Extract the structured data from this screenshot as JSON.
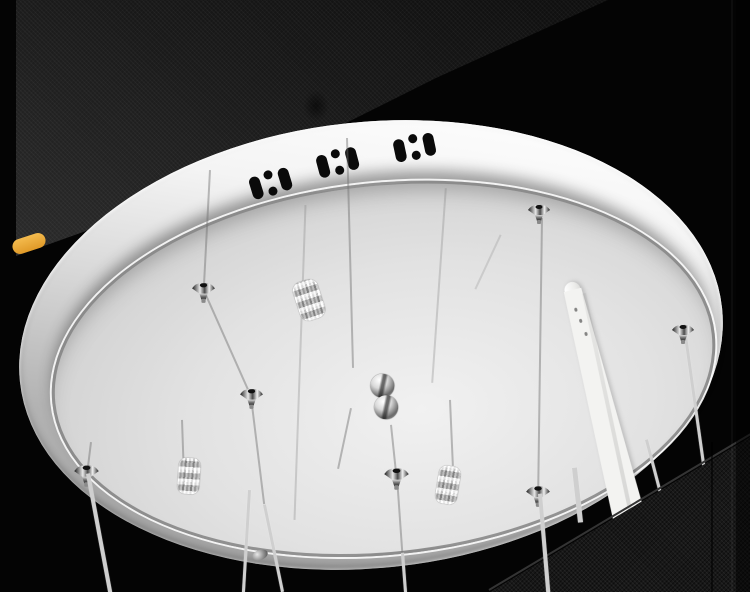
{
  "meta": {
    "kind": "product-photo",
    "description": "Close-up of the oval stainless-steel ceiling mount plate of a crystal LED pendant chandelier, photographed from below against a black backdrop"
  },
  "colors": {
    "background": "#040404",
    "plate_face": "#d9d9d9",
    "rim_highlight": "#ffffff",
    "rim_shadow": "#a3a3a3",
    "vent_hole": "#0a0a0a",
    "cable": "#cfcfcf",
    "accent_tag": "#eead3c",
    "panel_top": "#1c1c1c",
    "panel_mesh": "#181818",
    "tube": "#f3f3f1"
  },
  "objects": {
    "photo": {
      "label": "chandelier ceiling plate product photo"
    },
    "plate": {
      "label": "oval stainless-steel ceiling plate"
    },
    "vents": {
      "label": "ventilation cutouts on plate rim",
      "groups": 3,
      "pattern": "slot, twin dots, slot"
    },
    "wire_holders": {
      "label": "chrome cable grip holder",
      "count": 7
    },
    "crystal_beads": {
      "label": "faceted crystal bead",
      "count": 3
    },
    "knob": {
      "label": "chrome double-sphere knob",
      "count": 1
    },
    "tube": {
      "label": "frosted glass light tube"
    },
    "cables": {
      "label": "steel suspension cable"
    },
    "tag": {
      "label": "yellow cable tag"
    },
    "backdrop_top": {
      "label": "dark textured backdrop panel (top)"
    },
    "backdrop_mesh": {
      "label": "dark mesh backdrop panel (bottom right)"
    }
  }
}
